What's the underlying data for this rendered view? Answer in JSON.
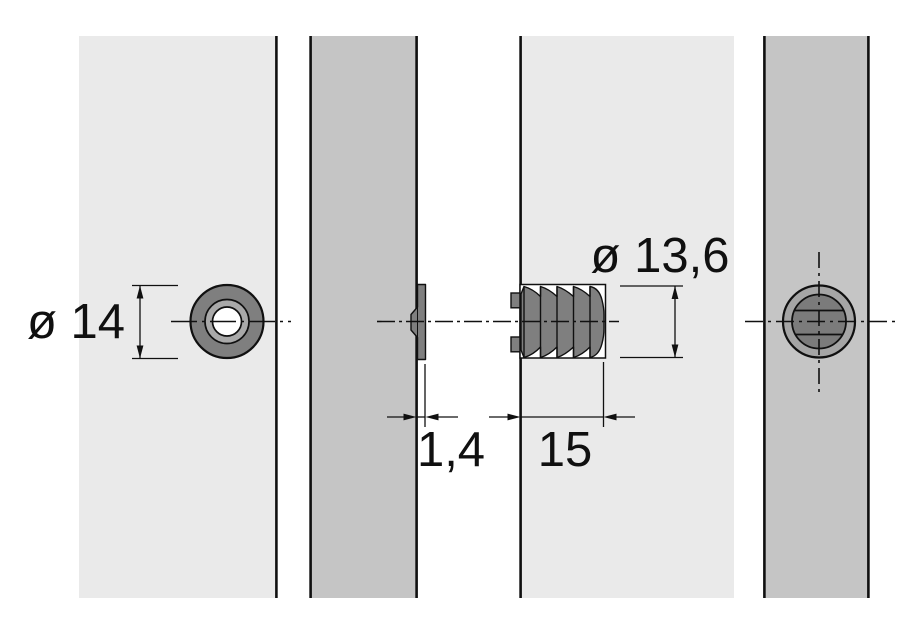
{
  "dimensions": {
    "sleeve_diameter": "ø 14",
    "plate_protrusion": "1,4",
    "plug_length": "15",
    "plug_diameter": "ø 13,6"
  },
  "colors": {
    "background": "#ffffff",
    "panel-light": "#eaeaea",
    "panel-mid": "#c5c5c5",
    "part-dark": "#7f7f7f",
    "part-light": "#a9a9a9",
    "ring-light": "#a5a5a5",
    "disc-dark": "#7b7b7b",
    "line": "#101010"
  }
}
